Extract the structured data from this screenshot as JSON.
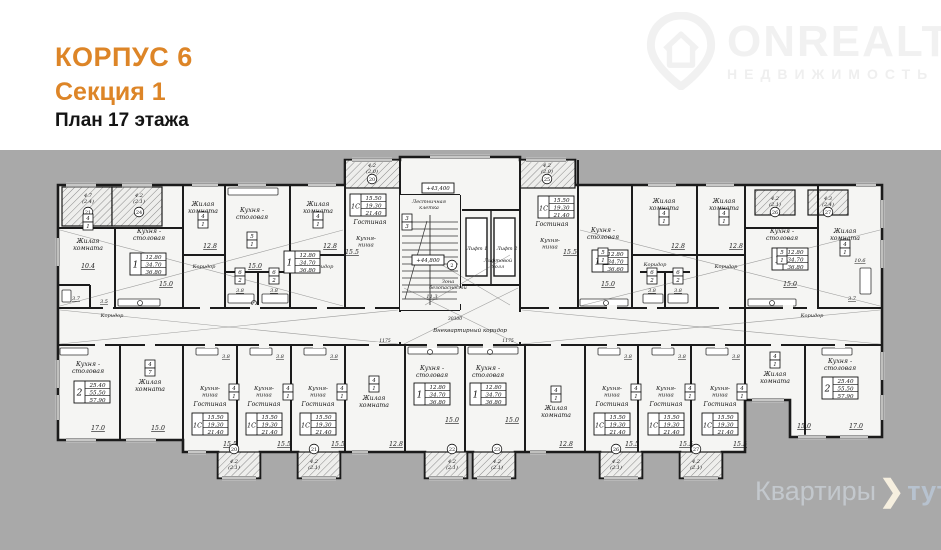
{
  "header": {
    "korpus": "КОРПУС 6",
    "section": "Секция 1",
    "floor": "План 17 этажа"
  },
  "brand": {
    "name": "ONREALT",
    "subtitle": "НЕДВИЖИМОСТЬ"
  },
  "watermark": {
    "part1": "Квартиры",
    "part2": "тут"
  },
  "colors": {
    "accent_orange": "#dd8527",
    "background_gray": "#a9a9a9",
    "paper_white": "#ffffff",
    "plan_fill": "#f5f5f3",
    "wall_ink": "#1b1b1b",
    "brand_gray": "#f1f1f1",
    "wm_gray": "#c3c8cd"
  },
  "plan": {
    "labels": [
      {
        "t": "4.7\n(2.4)",
        "x": 88,
        "y": 197,
        "s": 5
      },
      {
        "t": "4.2\n(2.1)",
        "x": 139,
        "y": 197,
        "s": 5
      },
      {
        "t": "Жилая\nкомната",
        "x": 88,
        "y": 243
      },
      {
        "t": "Кухня -\nстоловая",
        "x": 149,
        "y": 233
      },
      {
        "t": "10.4",
        "x": 88,
        "y": 268,
        "u": 1
      },
      {
        "t": "15.0",
        "x": 166,
        "y": 286,
        "u": 1
      },
      {
        "t": "3.7",
        "x": 76,
        "y": 300,
        "u": 1,
        "s": 5
      },
      {
        "t": "3.5",
        "x": 104,
        "y": 303,
        "u": 1,
        "s": 5
      },
      {
        "t": "Коридор",
        "x": 112,
        "y": 317,
        "s": 5
      },
      {
        "t": "Жилая\nкомната",
        "x": 203,
        "y": 206
      },
      {
        "t": "Кухня -\nстоловая",
        "x": 252,
        "y": 212
      },
      {
        "t": "Жилая\nкомната",
        "x": 318,
        "y": 206
      },
      {
        "t": "12.8",
        "x": 210,
        "y": 248,
        "u": 1
      },
      {
        "t": "12.8",
        "x": 330,
        "y": 248,
        "u": 1
      },
      {
        "t": "15.0",
        "x": 255,
        "y": 268,
        "u": 1
      },
      {
        "t": "Коридор",
        "x": 204,
        "y": 268,
        "s": 5
      },
      {
        "t": "Коридор",
        "x": 322,
        "y": 268,
        "s": 5
      },
      {
        "t": "3.8",
        "x": 240,
        "y": 292,
        "u": 1,
        "s": 5
      },
      {
        "t": "3.8",
        "x": 274,
        "y": 292,
        "u": 1,
        "s": 5
      },
      {
        "t": "4.2\n(2.0)",
        "x": 372,
        "y": 167,
        "s": 5
      },
      {
        "t": "Гостиная",
        "x": 370,
        "y": 224
      },
      {
        "t": "Кухня-\nниша",
        "x": 366,
        "y": 240,
        "s": 5.5
      },
      {
        "t": "15.5",
        "x": 352,
        "y": 254,
        "u": 1
      },
      {
        "t": "Лестничная\nклетка",
        "x": 429,
        "y": 203,
        "s": 5
      },
      {
        "t": "Лифт 1",
        "x": 477,
        "y": 250,
        "s": 5
      },
      {
        "t": "Лифт 2",
        "x": 507,
        "y": 250,
        "s": 5
      },
      {
        "t": "Лифтовой\nхолл",
        "x": 498,
        "y": 262,
        "s": 5
      },
      {
        "t": "Зона\nбезопасности",
        "x": 448,
        "y": 283,
        "s": 5
      },
      {
        "t": "11.3",
        "x": 432,
        "y": 298,
        "u": 1,
        "s": 5
      },
      {
        "t": "Внеквартирный коридор",
        "x": 470,
        "y": 332,
        "s": 5.5
      },
      {
        "t": "30300",
        "x": 455,
        "y": 320,
        "s": 4.5
      },
      {
        "t": "1175",
        "x": 508,
        "y": 342,
        "s": 4.5
      },
      {
        "t": "1175",
        "x": 385,
        "y": 342,
        "s": 4.5
      },
      {
        "t": "4.2\n(2.0)",
        "x": 547,
        "y": 167,
        "s": 5
      },
      {
        "t": "Гостиная",
        "x": 552,
        "y": 226
      },
      {
        "t": "Кухня-\nниша",
        "x": 550,
        "y": 242,
        "s": 5.5
      },
      {
        "t": "15.5",
        "x": 570,
        "y": 254,
        "u": 1
      },
      {
        "t": "Кухня -\nстоловая",
        "x": 603,
        "y": 232
      },
      {
        "t": "15.0",
        "x": 608,
        "y": 286,
        "u": 1
      },
      {
        "t": "Жилая\nкомната",
        "x": 664,
        "y": 203
      },
      {
        "t": "Жилая\nкомната",
        "x": 724,
        "y": 203
      },
      {
        "t": "12.8",
        "x": 678,
        "y": 248,
        "u": 1
      },
      {
        "t": "12.8",
        "x": 736,
        "y": 248,
        "u": 1
      },
      {
        "t": "Коридор",
        "x": 655,
        "y": 266,
        "s": 5
      },
      {
        "t": "Коридор",
        "x": 726,
        "y": 268,
        "s": 5
      },
      {
        "t": "3.8",
        "x": 652,
        "y": 292,
        "u": 1,
        "s": 5
      },
      {
        "t": "3.8",
        "x": 678,
        "y": 292,
        "u": 1,
        "s": 5
      },
      {
        "t": "4.2\n(2.1)",
        "x": 775,
        "y": 200,
        "s": 5
      },
      {
        "t": "4.3\n(2.4)",
        "x": 828,
        "y": 200,
        "s": 5
      },
      {
        "t": "Кухня -\nстоловая",
        "x": 782,
        "y": 233
      },
      {
        "t": "Жилая\nкомната",
        "x": 845,
        "y": 233
      },
      {
        "t": "15.0",
        "x": 790,
        "y": 286,
        "u": 1
      },
      {
        "t": "10.6",
        "x": 860,
        "y": 262,
        "u": 1,
        "s": 5
      },
      {
        "t": "3.7",
        "x": 852,
        "y": 300,
        "u": 1,
        "s": 5
      },
      {
        "t": "Коридор",
        "x": 812,
        "y": 317,
        "s": 5
      },
      {
        "t": "Кухня -\nстоловая",
        "x": 88,
        "y": 366
      },
      {
        "t": "Жилая\nкомната",
        "x": 150,
        "y": 384
      },
      {
        "t": "17.0",
        "x": 98,
        "y": 430,
        "u": 1
      },
      {
        "t": "15.0",
        "x": 158,
        "y": 430,
        "u": 1
      },
      {
        "t": "Кухня-\nниша",
        "x": 210,
        "y": 390,
        "s": 5.5
      },
      {
        "t": "Гостиная",
        "x": 210,
        "y": 406
      },
      {
        "t": "15.5",
        "x": 230,
        "y": 446,
        "u": 1
      },
      {
        "t": "3.8",
        "x": 226,
        "y": 358,
        "u": 1,
        "s": 5
      },
      {
        "t": "Кухня-\nниша",
        "x": 264,
        "y": 390,
        "s": 5.5
      },
      {
        "t": "Гостиная",
        "x": 264,
        "y": 406
      },
      {
        "t": "15.5",
        "x": 284,
        "y": 446,
        "u": 1
      },
      {
        "t": "3.8",
        "x": 280,
        "y": 358,
        "u": 1,
        "s": 5
      },
      {
        "t": "Кухня-\nниша",
        "x": 318,
        "y": 390,
        "s": 5.5
      },
      {
        "t": "Гостиная",
        "x": 318,
        "y": 406
      },
      {
        "t": "15.5",
        "x": 338,
        "y": 446,
        "u": 1
      },
      {
        "t": "3.8",
        "x": 334,
        "y": 358,
        "u": 1,
        "s": 5
      },
      {
        "t": "Жилая\nкомната",
        "x": 374,
        "y": 400
      },
      {
        "t": "12.8",
        "x": 396,
        "y": 446,
        "u": 1
      },
      {
        "t": "Кухня -\nстоловая",
        "x": 432,
        "y": 370
      },
      {
        "t": "Кухня -\nстоловая",
        "x": 488,
        "y": 370
      },
      {
        "t": "15.0",
        "x": 452,
        "y": 422,
        "u": 1
      },
      {
        "t": "15.0",
        "x": 512,
        "y": 422,
        "u": 1
      },
      {
        "t": "Жилая\nкомната",
        "x": 556,
        "y": 410
      },
      {
        "t": "12.8",
        "x": 566,
        "y": 446,
        "u": 1
      },
      {
        "t": "4.2\n(2.1)",
        "x": 234,
        "y": 463,
        "s": 5
      },
      {
        "t": "4.2\n(2.1)",
        "x": 314,
        "y": 463,
        "s": 5
      },
      {
        "t": "4.2\n(2.1)",
        "x": 452,
        "y": 463,
        "s": 5
      },
      {
        "t": "4.2\n(2.1)",
        "x": 497,
        "y": 463,
        "s": 5
      },
      {
        "t": "4.2\n(2.1)",
        "x": 616,
        "y": 463,
        "s": 5
      },
      {
        "t": "4.2\n(2.1)",
        "x": 696,
        "y": 463,
        "s": 5
      },
      {
        "t": "Кухня-\nниша",
        "x": 612,
        "y": 390,
        "s": 5.5
      },
      {
        "t": "Гостиная",
        "x": 612,
        "y": 406
      },
      {
        "t": "15.5",
        "x": 632,
        "y": 446,
        "u": 1
      },
      {
        "t": "3.8",
        "x": 628,
        "y": 358,
        "u": 1,
        "s": 5
      },
      {
        "t": "Кухня-\nниша",
        "x": 666,
        "y": 390,
        "s": 5.5
      },
      {
        "t": "Гостиная",
        "x": 666,
        "y": 406
      },
      {
        "t": "15.5",
        "x": 686,
        "y": 446,
        "u": 1
      },
      {
        "t": "3.8",
        "x": 682,
        "y": 358,
        "u": 1,
        "s": 5
      },
      {
        "t": "Кухня-\nниша",
        "x": 720,
        "y": 390,
        "s": 5.5
      },
      {
        "t": "Гостиная",
        "x": 720,
        "y": 406
      },
      {
        "t": "15.5",
        "x": 740,
        "y": 446,
        "u": 1
      },
      {
        "t": "3.8",
        "x": 736,
        "y": 358,
        "u": 1,
        "s": 5
      },
      {
        "t": "Жилая\nкомната",
        "x": 775,
        "y": 376
      },
      {
        "t": "Кухня -\nстоловая",
        "x": 840,
        "y": 363
      },
      {
        "t": "15.0",
        "x": 804,
        "y": 428,
        "u": 1
      },
      {
        "t": "17.0",
        "x": 856,
        "y": 428,
        "u": 1
      }
    ],
    "stamps": [
      {
        "x": 148,
        "y": 264,
        "r": "1",
        "v": [
          "12.80",
          "34.70",
          "36.80"
        ]
      },
      {
        "x": 302,
        "y": 262,
        "r": "1",
        "v": [
          "12.80",
          "34.70",
          "36.80"
        ]
      },
      {
        "x": 368,
        "y": 205,
        "r": "1С",
        "v": [
          "15.50",
          "19.30",
          "21.40"
        ]
      },
      {
        "x": 556,
        "y": 207,
        "r": "1С",
        "v": [
          "15.50",
          "19.30",
          "21.40"
        ]
      },
      {
        "x": 610,
        "y": 261,
        "r": "1",
        "v": [
          "12.80",
          "34.70",
          "36.60"
        ]
      },
      {
        "x": 790,
        "y": 259,
        "r": "1",
        "v": [
          "12.80",
          "34.70",
          "36.80"
        ]
      },
      {
        "x": 92,
        "y": 392,
        "r": "2",
        "v": [
          "25.40",
          "55.50",
          "57.90"
        ]
      },
      {
        "x": 210,
        "y": 424,
        "r": "1С",
        "v": [
          "15.50",
          "19.30",
          "21.40"
        ]
      },
      {
        "x": 264,
        "y": 424,
        "r": "1С",
        "v": [
          "15.50",
          "19.30",
          "21.40"
        ]
      },
      {
        "x": 318,
        "y": 424,
        "r": "1С",
        "v": [
          "15.50",
          "19.30",
          "21.40"
        ]
      },
      {
        "x": 432,
        "y": 394,
        "r": "1",
        "v": [
          "12.80",
          "34.70",
          "36.80"
        ]
      },
      {
        "x": 488,
        "y": 394,
        "r": "1",
        "v": [
          "12.80",
          "34.70",
          "36.80"
        ]
      },
      {
        "x": 612,
        "y": 424,
        "r": "1С",
        "v": [
          "15.50",
          "19.30",
          "21.40"
        ]
      },
      {
        "x": 666,
        "y": 424,
        "r": "1С",
        "v": [
          "15.50",
          "19.30",
          "21.40"
        ]
      },
      {
        "x": 720,
        "y": 424,
        "r": "1С",
        "v": [
          "15.50",
          "19.30",
          "21.40"
        ]
      },
      {
        "x": 840,
        "y": 388,
        "r": "2",
        "v": [
          "25.40",
          "55.50",
          "57.90"
        ]
      }
    ],
    "levels": [
      {
        "x": 438,
        "y": 188,
        "t": "+43,400"
      },
      {
        "x": 428,
        "y": 260,
        "t": "+44,800"
      }
    ],
    "circles": [
      {
        "x": 88,
        "y": 212,
        "n": "21"
      },
      {
        "x": 139,
        "y": 212,
        "n": "24"
      },
      {
        "x": 372,
        "y": 179,
        "n": "20"
      },
      {
        "x": 547,
        "y": 179,
        "n": "25"
      },
      {
        "x": 775,
        "y": 212,
        "n": "26"
      },
      {
        "x": 828,
        "y": 212,
        "n": "27"
      },
      {
        "x": 234,
        "y": 449,
        "n": "20"
      },
      {
        "x": 314,
        "y": 449,
        "n": "21"
      },
      {
        "x": 452,
        "y": 449,
        "n": "22"
      },
      {
        "x": 497,
        "y": 449,
        "n": "23"
      },
      {
        "x": 616,
        "y": 449,
        "n": "26"
      },
      {
        "x": 696,
        "y": 449,
        "n": "27"
      },
      {
        "x": 452,
        "y": 265,
        "n": "2"
      }
    ],
    "pairs": [
      {
        "x": 88,
        "y": 222,
        "a": "4",
        "b": "1"
      },
      {
        "x": 203,
        "y": 220,
        "a": "4",
        "b": "1"
      },
      {
        "x": 318,
        "y": 220,
        "a": "4",
        "b": "1"
      },
      {
        "x": 664,
        "y": 217,
        "a": "4",
        "b": "1"
      },
      {
        "x": 724,
        "y": 217,
        "a": "4",
        "b": "1"
      },
      {
        "x": 845,
        "y": 248,
        "a": "4",
        "b": "1"
      },
      {
        "x": 252,
        "y": 240,
        "a": "5",
        "b": "1"
      },
      {
        "x": 603,
        "y": 256,
        "a": "5",
        "b": "1"
      },
      {
        "x": 782,
        "y": 256,
        "a": "5",
        "b": "1"
      },
      {
        "x": 240,
        "y": 276,
        "a": "6",
        "b": "2"
      },
      {
        "x": 274,
        "y": 276,
        "a": "6",
        "b": "2"
      },
      {
        "x": 652,
        "y": 276,
        "a": "6",
        "b": "2"
      },
      {
        "x": 678,
        "y": 276,
        "a": "6",
        "b": "2"
      },
      {
        "x": 150,
        "y": 368,
        "a": "4",
        "b": "7"
      },
      {
        "x": 374,
        "y": 384,
        "a": "4",
        "b": "1"
      },
      {
        "x": 556,
        "y": 394,
        "a": "4",
        "b": "1"
      },
      {
        "x": 775,
        "y": 360,
        "a": "4",
        "b": "1"
      },
      {
        "x": 234,
        "y": 392,
        "a": "4",
        "b": "1"
      },
      {
        "x": 288,
        "y": 392,
        "a": "4",
        "b": "1"
      },
      {
        "x": 342,
        "y": 392,
        "a": "4",
        "b": "1"
      },
      {
        "x": 636,
        "y": 392,
        "a": "4",
        "b": "1"
      },
      {
        "x": 690,
        "y": 392,
        "a": "4",
        "b": "1"
      },
      {
        "x": 742,
        "y": 392,
        "a": "4",
        "b": "1"
      },
      {
        "x": 407,
        "y": 222,
        "a": "3",
        "b": "3"
      }
    ]
  }
}
